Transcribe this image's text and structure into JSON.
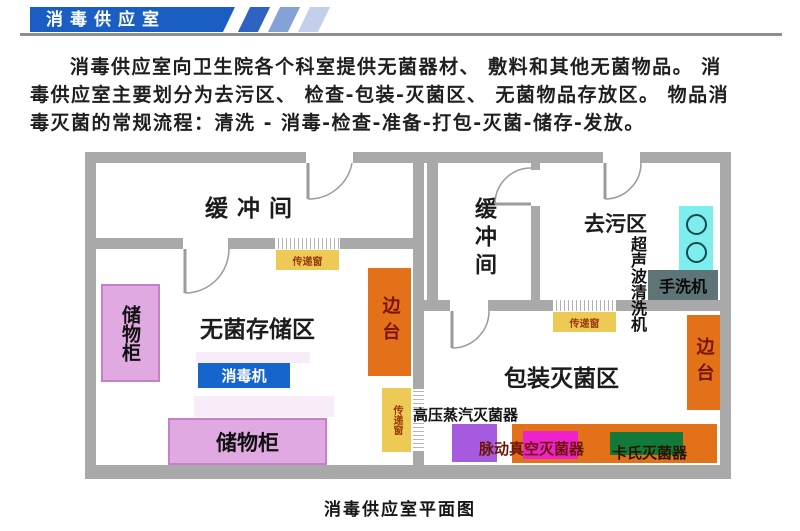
{
  "header": {
    "banner_title": "消毒供应室"
  },
  "intro": {
    "lines": [
      "消毒供应室向卫生院各个科室提供无菌器材、 敷料和其他无菌物品。 消",
      "毒供应室主要划分为去污区、 检查-包装-灭菌区、 无菌物品存放区。 物品消",
      "毒灭菌的常规流程：清洗 - 消毒-检查-准备-打包-灭菌-储存-发放。"
    ]
  },
  "floor_plan": {
    "caption": "消毒供应室平面图",
    "rooms": {
      "buffer": "缓冲间",
      "decontamination": "去污区",
      "sterile_storage": "无菌存储区",
      "packaging_sterilization": "包装灭菌区"
    },
    "equipment": {
      "storage_cabinet": "储物柜",
      "disinfector": "消毒机",
      "side_table": "边台",
      "pass_window": "传递窗",
      "ultrasonic_cleaner": "超声波清洗机",
      "hand_washer": "手洗机",
      "autoclave": "高压蒸汽灭菌器",
      "pulse_vacuum_sterilizer": "脉动真空灭菌器",
      "cassette_sterilizer": "卡氏灭菌器"
    },
    "colors": {
      "banner_blue": "#1a5ec4",
      "wall_gray": "#a9a9a9",
      "pass_window_yellow": "#ecca55",
      "cabinet_plum": "#e0a9e2",
      "side_table_orange": "#e2711a",
      "disinfector_blue": "#1565cd",
      "sink_cyan": "#7deeed",
      "hand_washer_slate": "#5e7476",
      "sterilizer_purple": "#a55ae0",
      "sterilizer_magenta": "#ee22cc",
      "sterilizer_green": "#117a3a"
    }
  }
}
